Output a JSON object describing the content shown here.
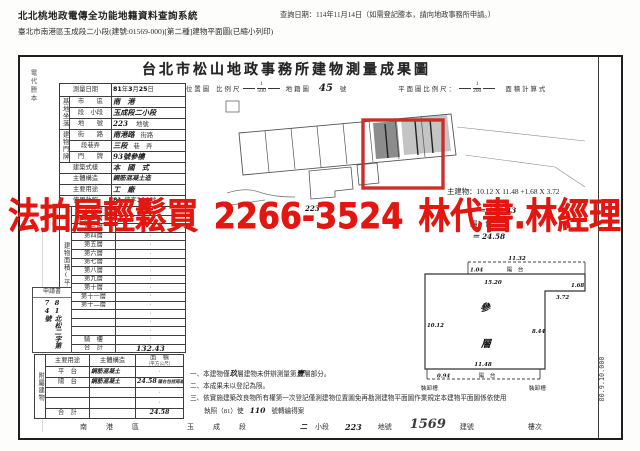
{
  "header": {
    "system_title": "北北桃地政電傳全功能地籍資料查詢系統",
    "query_date": "查詢日期：114年11月14日（如需登記謄本，請向地政事務所申請。）",
    "doc_line": "臺北市南港區玉成段二小段(建號:01569-000)[第二種]建物平面圖(已縮小列印)"
  },
  "watermark": {
    "text": "法拍屋輕鬆買 2266-3524 林代書.林經理",
    "color": "#e3170f"
  },
  "document": {
    "title": "台北市松山地政事務所建物測量成果圖",
    "margin_note": "電代謄本",
    "print_code": "80.9.10.000",
    "scales": {
      "location_map": "位置圖",
      "scale": "比例尺",
      "loc_num": "1",
      "loc_den": "500",
      "cadastre": "地籍圖",
      "cadastre_no": "45",
      "cadastre_unit": "號",
      "plan_scale": "平面圖比例尺：",
      "plan_num": "1",
      "plan_den": "200",
      "area_calc": "面積計算式"
    },
    "form": {
      "survey_label": "測量日期",
      "survey_year": "81",
      "survey_y": "年",
      "survey_month": "3",
      "survey_m": "月",
      "survey_day": "25",
      "survey_d": "日",
      "site_group": "基地坐落",
      "city_label": "市　　區",
      "city_value": "南　港",
      "section_label": "段　小段",
      "section_value": "玉成段二小段",
      "lot_label": "地　　號",
      "lot_value": "223",
      "lot_unit": "地號",
      "door_group": "建物門牌",
      "street_label": "街　　路",
      "street_value": "南港路",
      "street_unit": "街路",
      "lane_label": "段巷弄",
      "lane_value": "三段",
      "lane_unit": "巷　弄",
      "door_label": "門　　牌",
      "door_value": "93號參樓",
      "style_label": "建築式樣",
      "style_value": "本　國　式",
      "structure_label": "主體構造",
      "structure_value": "鋼筋混凝土造",
      "use_label": "主要用途",
      "use_value": "工　廠",
      "license_label": "使用執照",
      "license_no1": "81.",
      "license_mid": "使字",
      "license_no2": "110",
      "license_unit": "號"
    },
    "floor_table": {
      "group_label": "建物面積(平方公尺)",
      "rows": [
        {
          "label": "地面層",
          "value": "·"
        },
        {
          "label": "第二層",
          "value": "·"
        },
        {
          "label": "第三層",
          "value": "·"
        },
        {
          "label": "第四層",
          "value": "·"
        },
        {
          "label": "第五層",
          "value": "·"
        },
        {
          "label": "第六層",
          "value": "·"
        },
        {
          "label": "第七層",
          "value": "·"
        },
        {
          "label": "第八層",
          "value": "·"
        },
        {
          "label": "第九層",
          "value": "·"
        },
        {
          "label": "第十層",
          "value": "·"
        },
        {
          "label": "第十一層",
          "value": "·"
        },
        {
          "label": "第十二層",
          "value": "·"
        },
        {
          "label": "",
          "value": "·"
        },
        {
          "label": "",
          "value": "·"
        },
        {
          "label": "",
          "value": "·"
        },
        {
          "label": "騎　樓",
          "value": "·"
        },
        {
          "label": "合　計",
          "value": "132.43",
          "hand": true
        }
      ]
    },
    "application_box": {
      "label": "申請書",
      "content": "81北松二字第74號"
    },
    "attached_table": {
      "group_label": "附屬建物",
      "col_use": "主要用途",
      "col_structure": "主體構造",
      "col_area": "面　積",
      "col_area_unit": "（平方公尺）",
      "rows": [
        {
          "use": "平　台",
          "structure": "鋼筋混凝土",
          "area": "·"
        },
        {
          "use": "陽　台",
          "structure": "鋼筋混凝土",
          "area": "24.58",
          "note": "陽台包括雨遮",
          "hand": true
        },
        {
          "use": "",
          "structure": "",
          "area": "·"
        },
        {
          "use": "",
          "structure": "",
          "area": "·"
        },
        {
          "use": "合　計",
          "structure": "",
          "area": "24.58",
          "hand": true
        }
      ]
    },
    "calc": {
      "line1": "主建物：10.12 X 11.48 +1.68 X 3.72",
      "line2": "＝ 132.43",
      "line3": "陽　台：",
      "line4": "＝ 24.58"
    },
    "plan": {
      "dim_top": "11.32",
      "balcony_depth_top": "1.04",
      "balcony_top": "陽　台",
      "dim_inner_top": "15.20",
      "notch_h": "1.68",
      "notch_w": "3.72",
      "dim_left": "10.12",
      "dim_right": "8.44",
      "dim_bottom": "11.48",
      "balcony_depth_bottom": "0.94",
      "balcony_bottom": "陽　台",
      "floor_char1": "參",
      "floor_char2": "層",
      "dock_left": "裝卸槽",
      "dock_right": "裝卸槽"
    },
    "map": {
      "hand_lot": "223",
      "red_box_color": "#cc2f28"
    },
    "notes": {
      "n1_pre": "一、本建物僅",
      "n1_hand1": "玖",
      "n1_mid": "層建物未併辦測量第",
      "n1_hand2": "壹",
      "n1_post": "層部分。",
      "n2": "二、本成果未以登記為限。",
      "n3": "三、依實施建築改良物所有權第一次登記僅測建物位置圖免再勘測建物平面圖作業規定本建物平面圖係依使用",
      "n4_pre": "執照（81）使",
      "n4_no": "110",
      "n4_post": "號轉繪得案"
    },
    "bottom": {
      "b1": "南　港　區",
      "b2": "玉　成　段",
      "b3": "二",
      "b4": "小段",
      "b5": "223",
      "b6": "地號",
      "b7": "1569",
      "b8": "建號",
      "b9": "樓次"
    }
  }
}
